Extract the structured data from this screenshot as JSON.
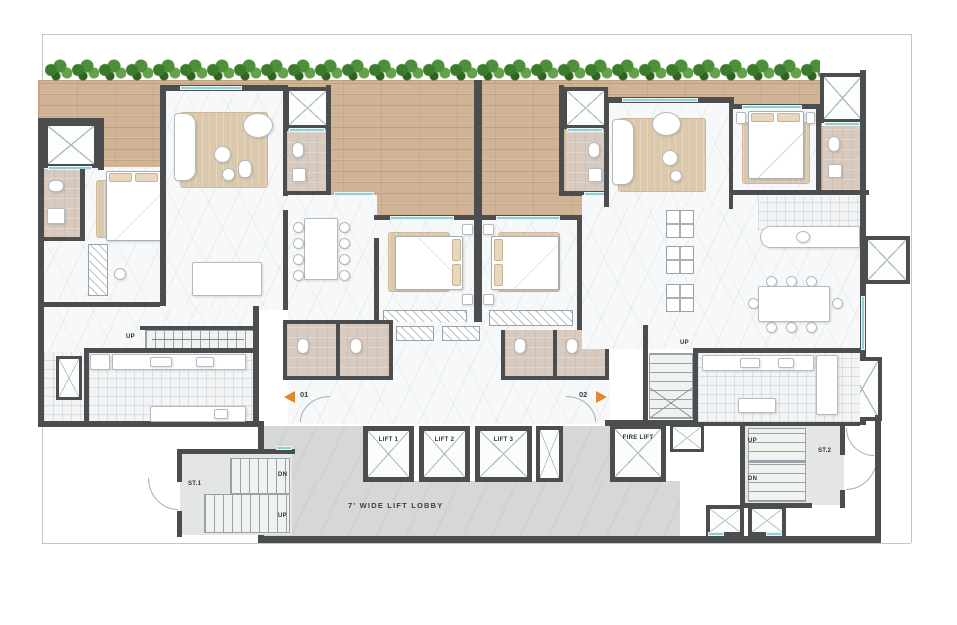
{
  "title": "Residential tower typical floor plan with two units and central lift lobby",
  "labels": {
    "lift1": "LIFT 1",
    "lift2": "LIFT 2",
    "lift3": "LIFT 3",
    "fire_lift": "FIRE LIFT",
    "lobby": "7' WIDE LIFT LOBBY",
    "up": "UP",
    "dn": "DN",
    "st1": "ST.1",
    "st2": "ST.2",
    "unit1": "01",
    "unit2": "02"
  },
  "colors": {
    "wall": "#4b4d4f",
    "deck_wood": "#d1b496",
    "hedge_green": "#4e8f3a",
    "window_glass": "#8fd0d4",
    "lobby_floor": "#d6d8d5",
    "bath_floor": "#d8cabe",
    "rug_beige": "#dcc9ad",
    "stair_floor": "#e4e6e4",
    "entry_arrow": "#e0872f"
  }
}
